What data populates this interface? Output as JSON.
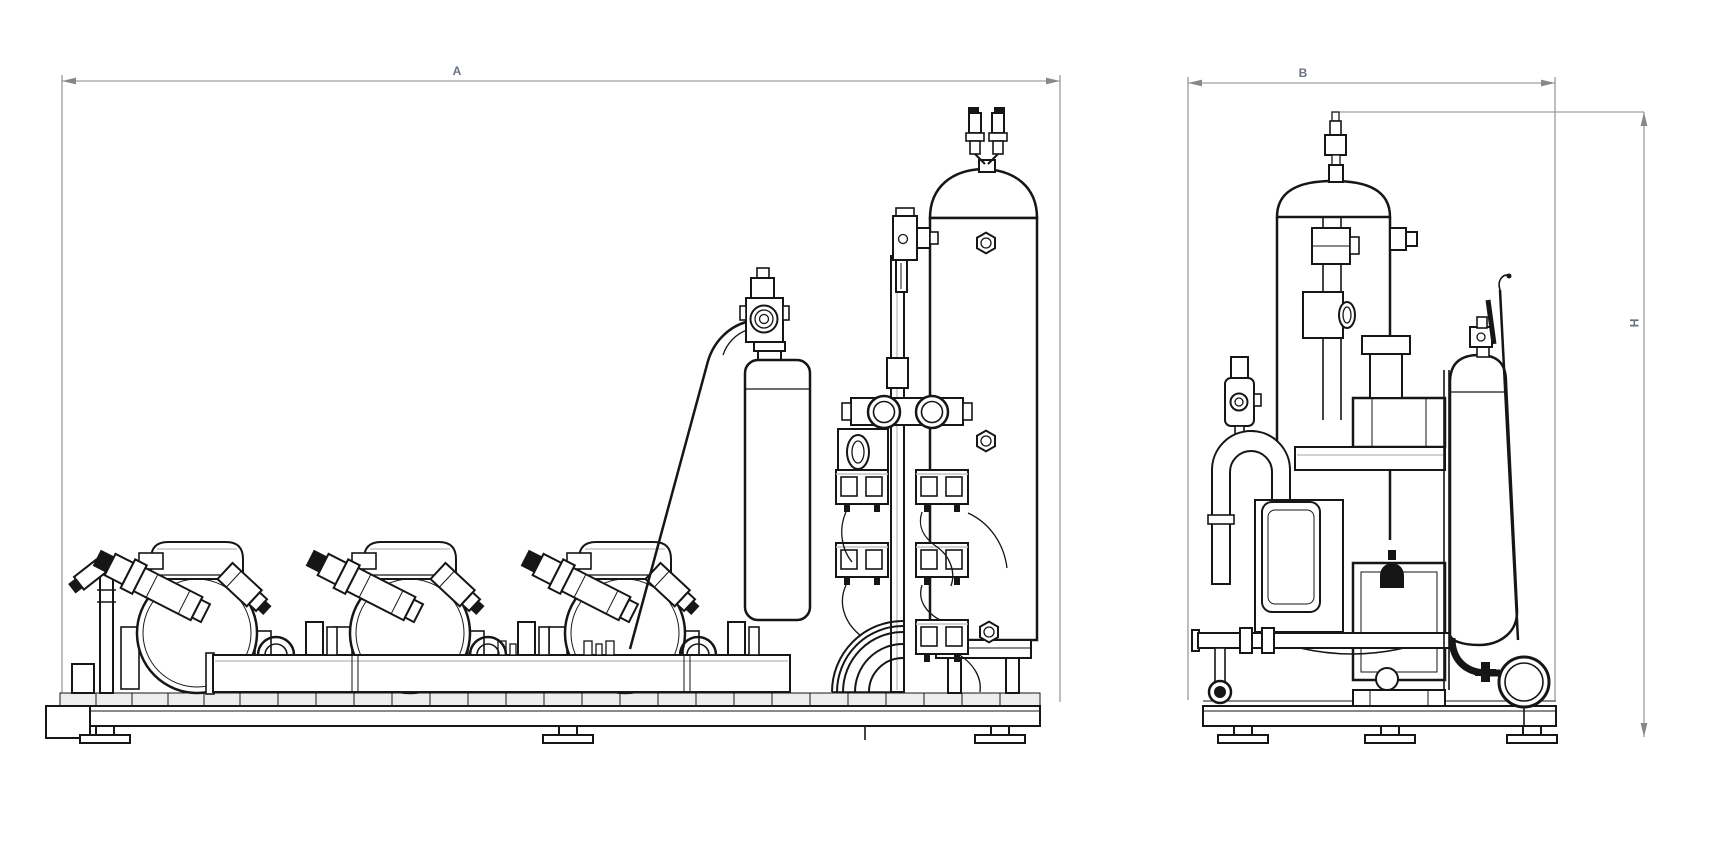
{
  "drawing": {
    "type": "technical-engineering-drawing",
    "background_color": "#ffffff",
    "stroke_color": "#161616",
    "dimensions": {
      "line_color": "#85898c",
      "label_color": "#68717f",
      "front_width": "A",
      "side_width": "B",
      "side_height": "H"
    },
    "views": [
      {
        "id": "front-elevation",
        "position": "left",
        "width_label": "A",
        "components": [
          "compressor-1",
          "compressor-2",
          "compressor-3",
          "suction-header",
          "oil-reservoir",
          "pressure-regulator",
          "capillary-tube",
          "valve-station",
          "liquid-receiver",
          "base-frame"
        ]
      },
      {
        "id": "side-elevation",
        "position": "right",
        "width_label": "B",
        "height_label": "H",
        "components": [
          "suction-accumulator",
          "oil-filter",
          "gooseneck-pipe",
          "compressor-body",
          "oil-separator",
          "discharge-elbow",
          "base-frame"
        ]
      }
    ]
  }
}
